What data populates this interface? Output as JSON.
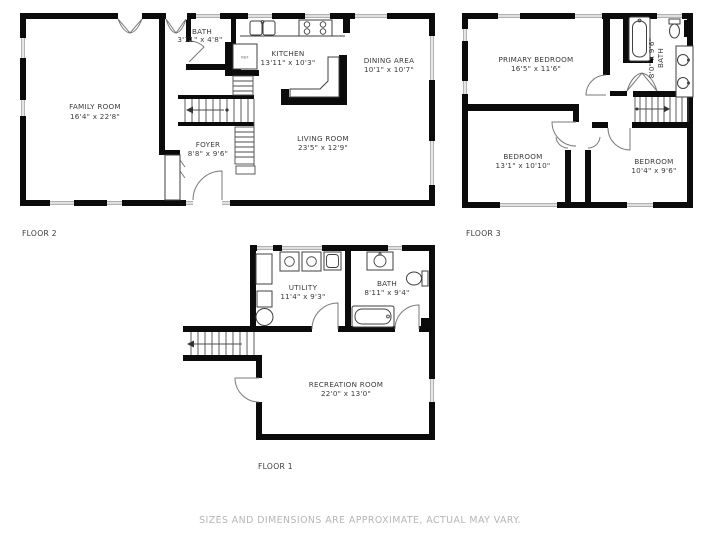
{
  "page": {
    "background": "#ffffff"
  },
  "disclaimer": "SIZES AND DIMENSIONS ARE APPROXIMATE, ACTUAL MAY VARY.",
  "colors": {
    "wall": "#0b0b0b",
    "room_text": "#3b3b3b",
    "disclaimer_text": "#b5b5b5"
  },
  "floors": {
    "floor2": {
      "label": "FLOOR 2",
      "rooms": {
        "family_room": {
          "name": "FAMILY ROOM",
          "dims": "16'4\" x 22'8\""
        },
        "bath": {
          "name": "BATH",
          "dims": "3'11\" x 4'8\""
        },
        "kitchen": {
          "name": "KITCHEN",
          "dims": "13'11\" x 10'3\""
        },
        "dining_area": {
          "name": "DINING AREA",
          "dims": "10'1\" x 10'7\""
        },
        "foyer": {
          "name": "FOYER",
          "dims": "8'8\" x 9'6\""
        },
        "living_room": {
          "name": "LIVING ROOM",
          "dims": "23'5\" x 12'9\""
        }
      },
      "fixtures": {
        "refrigerator": "REF"
      }
    },
    "floor3": {
      "label": "FLOOR 3",
      "rooms": {
        "primary_bedroom": {
          "name": "PRIMARY BEDROOM",
          "dims": "16'5\" x 11'6\""
        },
        "bath": {
          "name": "BATH",
          "dims": "8'0\" x 9'6\""
        },
        "bedroom_left": {
          "name": "BEDROOM",
          "dims": "13'1\" x 10'10\""
        },
        "bedroom_right": {
          "name": "BEDROOM",
          "dims": "10'4\" x 9'6\""
        }
      }
    },
    "floor1": {
      "label": "FLOOR 1",
      "rooms": {
        "utility": {
          "name": "UTILITY",
          "dims": "11'4\" x 9'3\""
        },
        "bath": {
          "name": "BATH",
          "dims": "8'11\" x 9'4\""
        },
        "recreation_room": {
          "name": "RECREATION ROOM",
          "dims": "22'0\" x 13'0\""
        }
      }
    }
  }
}
